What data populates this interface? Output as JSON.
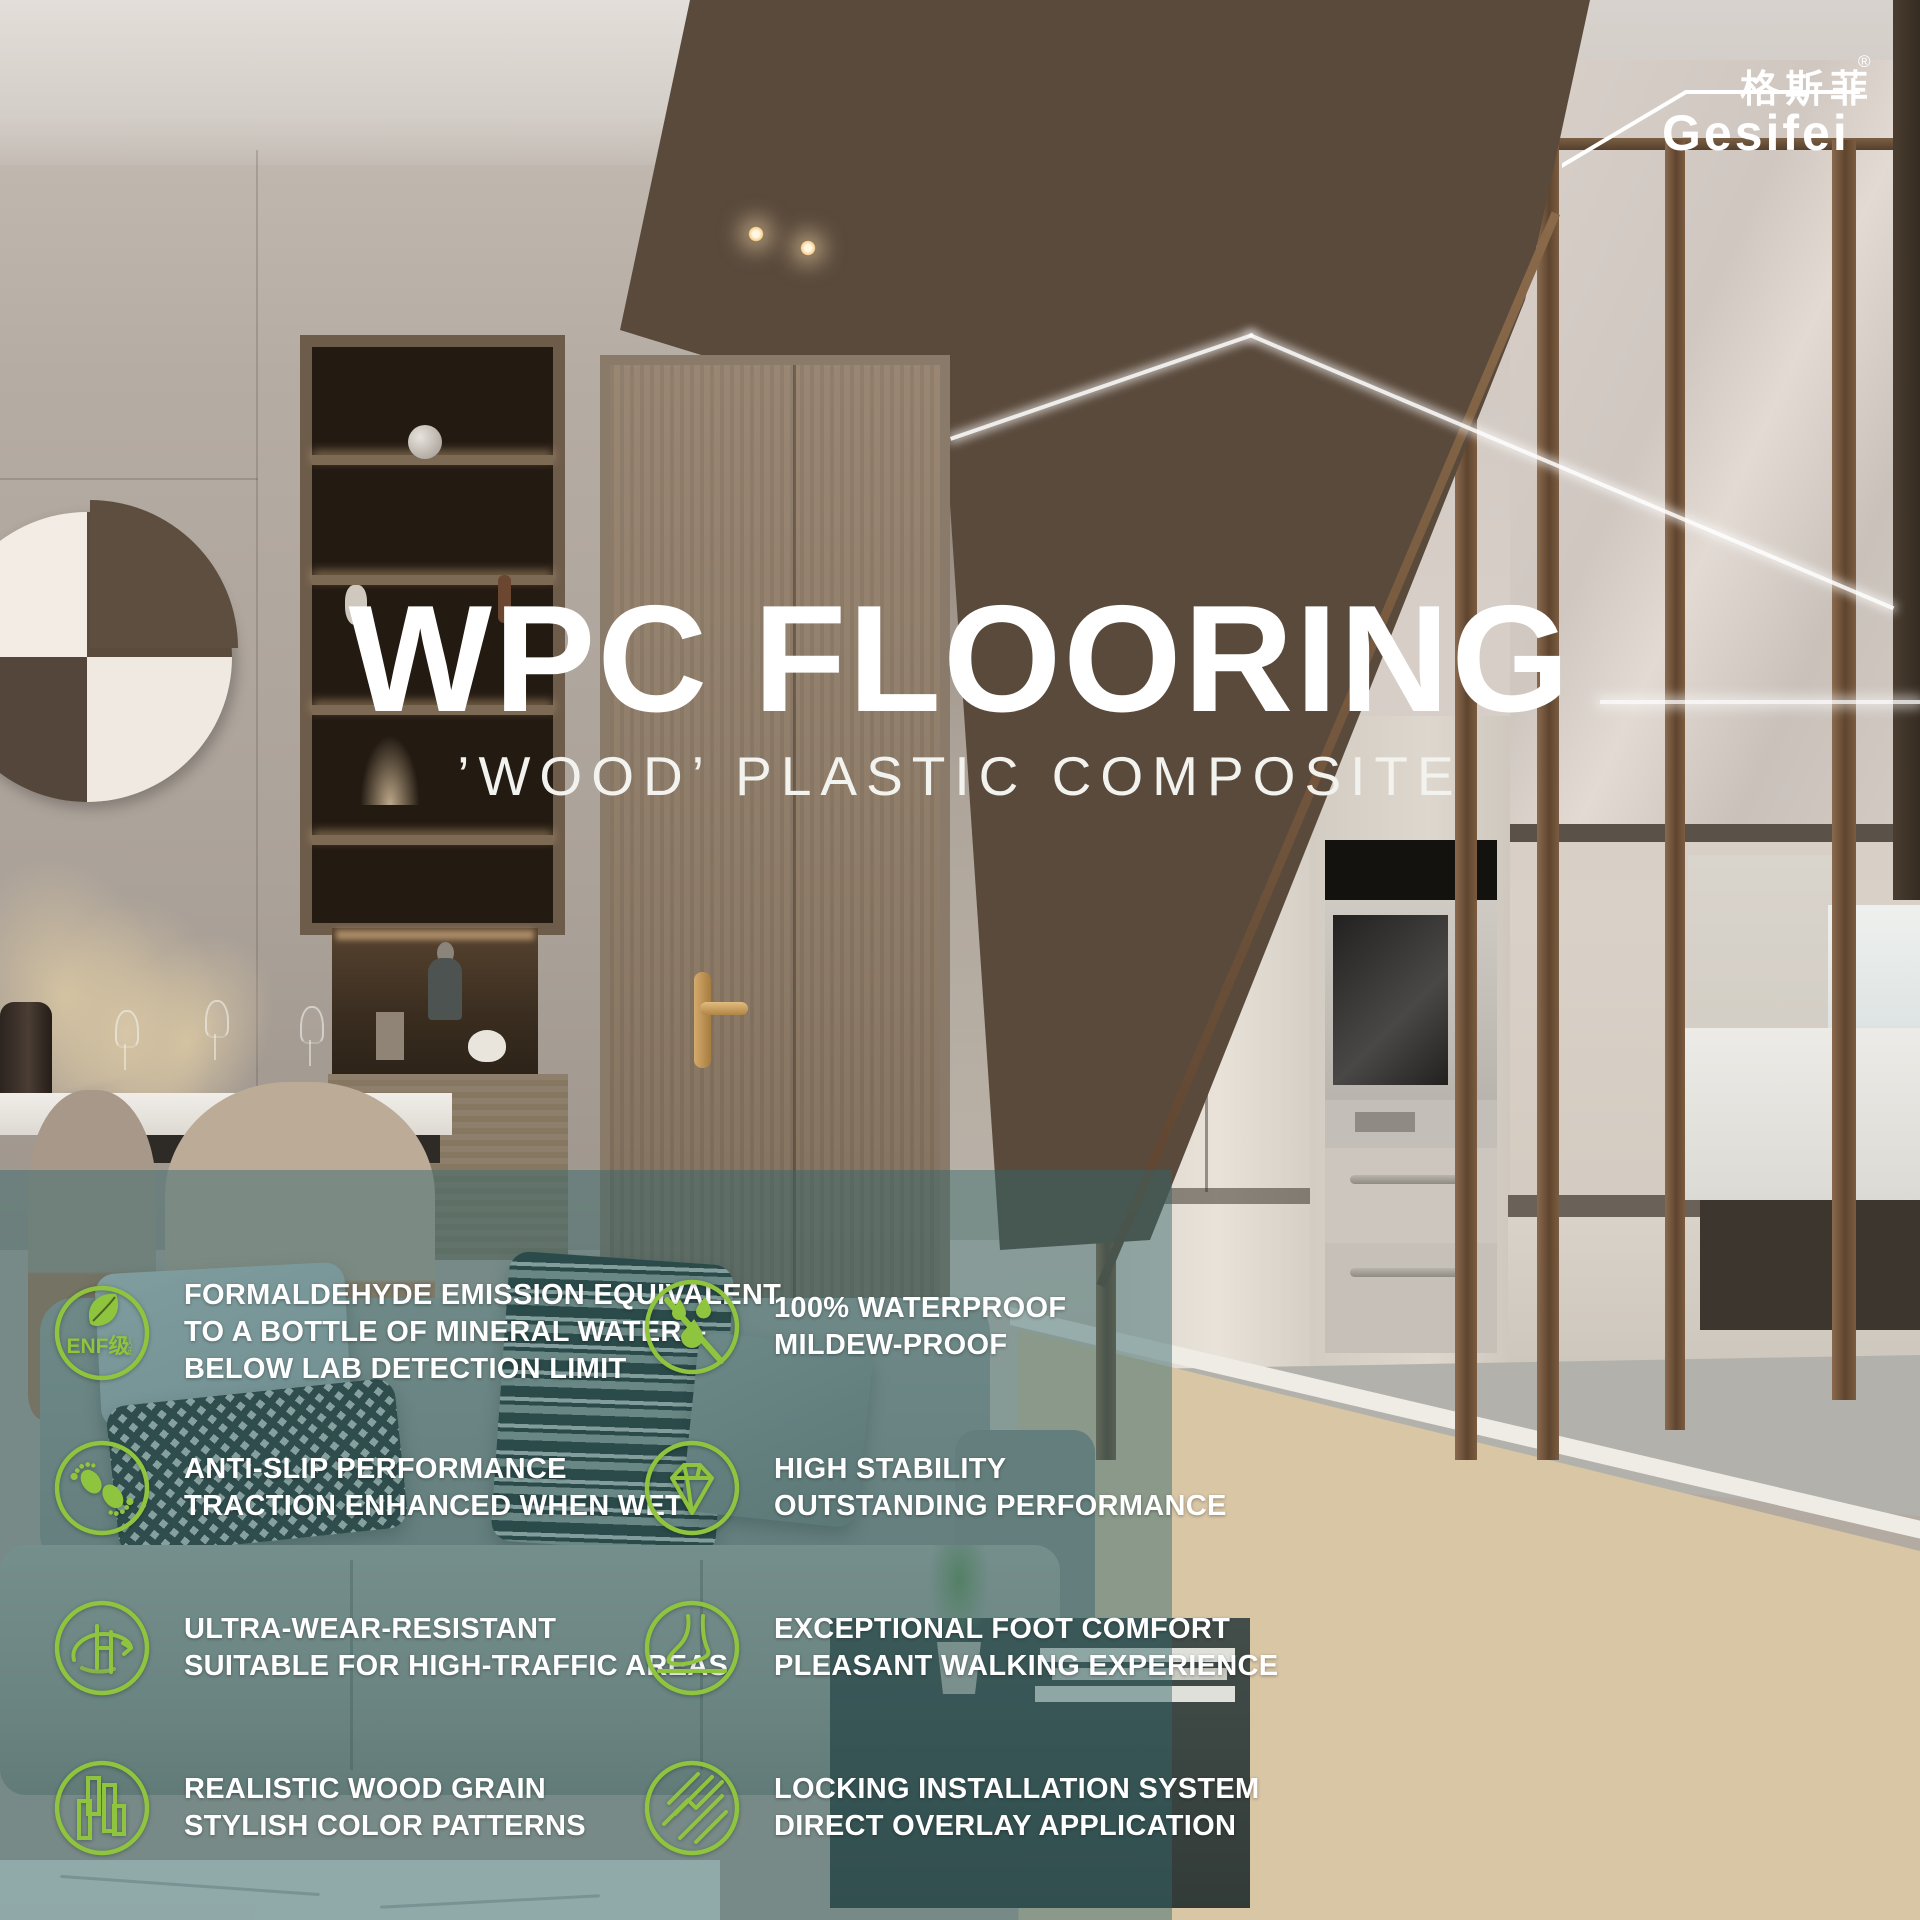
{
  "brand": {
    "logo_cn": "格斯菲",
    "registered_mark": "®",
    "logo_en": "Gesifei"
  },
  "hero": {
    "title": "WPC FLOORING",
    "subtitle": "’WOOD’ PLASTIC COMPOSITE"
  },
  "photo": {
    "appliance_brand": "Panasonic"
  },
  "features": [
    {
      "icon": "enf-certification-leaf-icon",
      "icon_label": "ENF级",
      "icon_sublabel": "认证",
      "lines": [
        "FORMALDEHYDE EMISSION EQUIVALENT",
        "TO A BOTTLE OF MINERAL WATER –",
        "BELOW LAB DETECTION LIMIT"
      ]
    },
    {
      "icon": "waterproof-drops-icon",
      "lines": [
        "100% WATERPROOF",
        "MILDEW-PROOF"
      ]
    },
    {
      "icon": "anti-slip-footprints-icon",
      "lines": [
        "ANTI-SLIP PERFORMANCE",
        "TRACTION ENHANCED WHEN WET"
      ]
    },
    {
      "icon": "stability-diamond-icon",
      "lines": [
        "HIGH STABILITY",
        "OUTSTANDING PERFORMANCE"
      ]
    },
    {
      "icon": "wear-resistant-orbit-icon",
      "lines": [
        "ULTRA-WEAR-RESISTANT",
        "SUITABLE FOR HIGH-TRAFFIC AREAS"
      ]
    },
    {
      "icon": "foot-comfort-icon",
      "lines": [
        "EXCEPTIONAL FOOT COMFORT",
        "PLEASANT WALKING EXPERIENCE"
      ]
    },
    {
      "icon": "wood-grain-icon",
      "lines": [
        "REALISTIC WOOD GRAIN",
        "STYLISH COLOR PATTERNS"
      ]
    },
    {
      "icon": "locking-installation-icon",
      "lines": [
        "LOCKING INSTALLATION SYSTEM",
        "DIRECT OVERLAY APPLICATION"
      ]
    }
  ],
  "colors": {
    "accent_green": "#8FC43E",
    "overlay_teal": "rgba(50,102,106,0.47)",
    "text_white": "#FFFFFF"
  }
}
